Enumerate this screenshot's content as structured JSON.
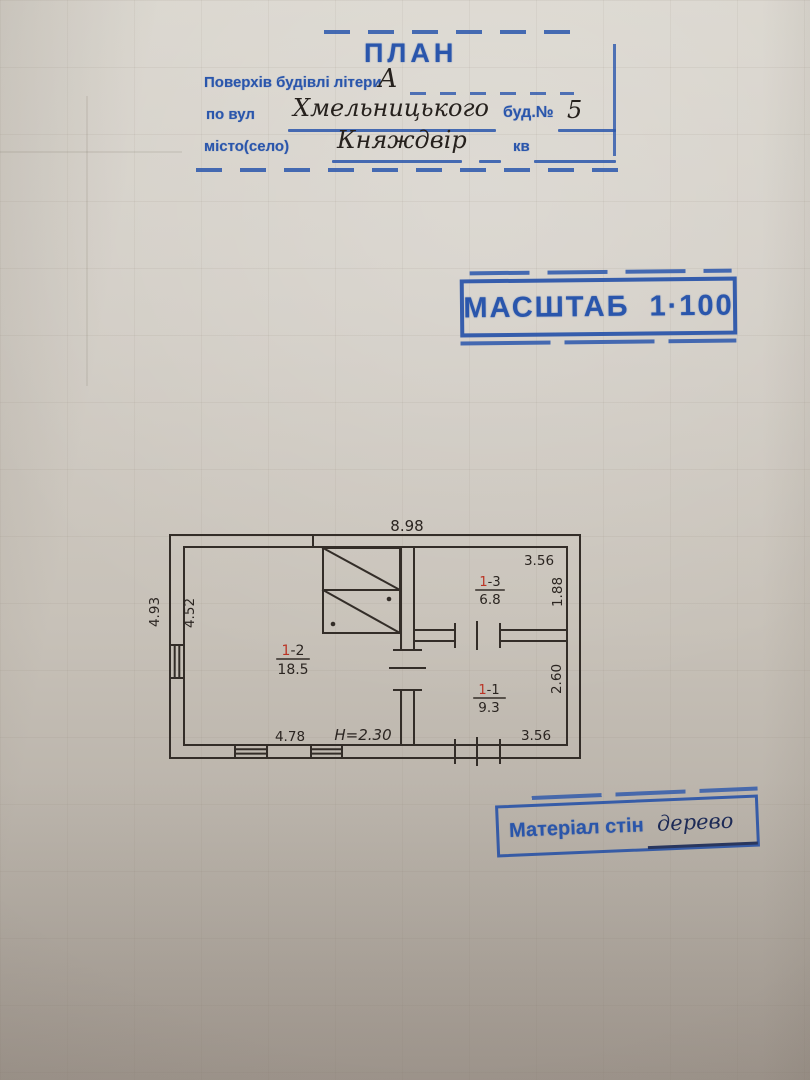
{
  "stamp_plan": {
    "title": "ПЛАН",
    "floors_label": "Поверхів будівлі літери",
    "floors_value": "А",
    "street_label": "по вул",
    "street_value": "Хмельницького",
    "building_label": "буд.№",
    "building_value": "5",
    "city_label": "місто(село)",
    "city_value": "Княждвір",
    "apt_label": "кв"
  },
  "stamp_scale": {
    "label": "МАСШТАБ",
    "value": "1·100"
  },
  "stamp_material": {
    "label": "Матеріал стін",
    "value": "дерево"
  },
  "plan": {
    "dim_top": "8.98",
    "dim_left_outer": "4.93",
    "dim_left_inner": "4.52",
    "dim_bottom_left": "4.78",
    "height_note": "H=2.30",
    "rooms": {
      "living": {
        "num_prefix": "1",
        "num_suffix": "-2",
        "area": "18.5"
      },
      "small": {
        "num_prefix": "1",
        "num_suffix": "-3",
        "area": "6.8",
        "dim_width": "3.56",
        "dim_height": "1.88"
      },
      "kitchen": {
        "num_prefix": "1",
        "num_suffix": "-1",
        "area": "9.3",
        "dim_width": "3.56",
        "dim_height": "2.60"
      }
    }
  },
  "colors": {
    "stamp_blue": "#2a56ac",
    "ink_black": "#2b2521",
    "ink_red": "#bb3425",
    "ink_blue": "#3743b8",
    "plan_line": "#332d28"
  }
}
